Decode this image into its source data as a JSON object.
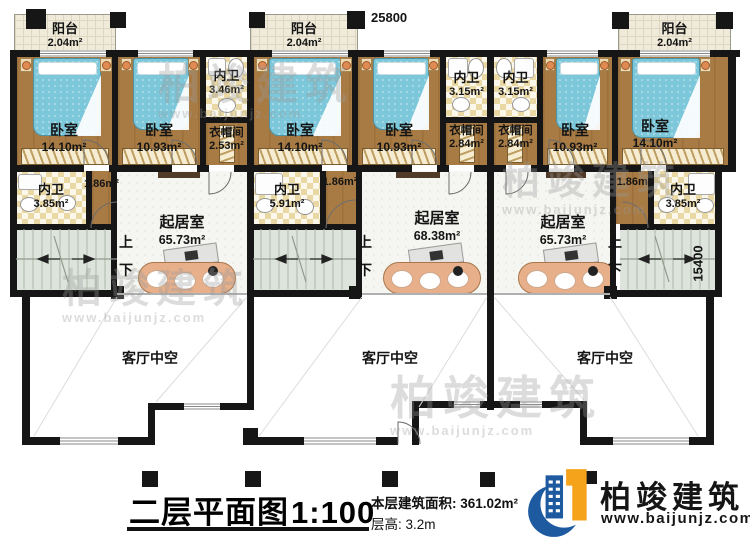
{
  "plan": {
    "dim_top": "25800",
    "dim_right": "15400",
    "up": "上",
    "down": "下",
    "balcony": {
      "name": "阳台",
      "area": "2.04m²"
    },
    "units": [
      {
        "bedroom1": {
          "name": "卧室",
          "area": "14.10m²"
        },
        "bedroom2": {
          "name": "卧室",
          "area": "10.93m²"
        },
        "bath_top": {
          "name": "内卫",
          "area": "3.46m²"
        },
        "closet": {
          "name": "衣帽间",
          "area": "2.53m²"
        },
        "hall_area": "1.86m²",
        "bath_mid": {
          "name": "内卫",
          "area": "3.85m²"
        },
        "living": {
          "name": "起居室",
          "area": "65.73m²"
        },
        "void_label": "客厅中空"
      },
      {
        "bedroom1": {
          "name": "卧室",
          "area": "14.10m²"
        },
        "bedroom2": {
          "name": "卧室",
          "area": "10.93m²"
        },
        "bath_top": {
          "name": "内卫",
          "area": "3.15m²"
        },
        "closet": {
          "name": "衣帽间",
          "area": "2.84m²"
        },
        "hall_area": "1.86m²",
        "bath_mid": {
          "name": "内卫",
          "area": "5.91m²"
        },
        "living": {
          "name": "起居室",
          "area": "68.38m²"
        },
        "void_label": "客厅中空"
      },
      {
        "bedroom1": {
          "name": "卧室",
          "area": "14.10m²"
        },
        "bedroom2": {
          "name": "卧室",
          "area": "10.93m²"
        },
        "bath_top": {
          "name": "内卫",
          "area": "3.15m²"
        },
        "closet": {
          "name": "衣帽间",
          "area": "2.84m²"
        },
        "hall_area": "1.86m²",
        "bath_mid": {
          "name": "内卫",
          "area": "3.85m²"
        },
        "living": {
          "name": "起居室",
          "area": "65.73m²"
        },
        "void_label": "客厅中空"
      }
    ]
  },
  "titleblock": {
    "title": "二层平面图",
    "scale": "1:100",
    "area_label": "本层建筑面积:",
    "area_value": "361.02m²",
    "floor_height_label": "层高:",
    "floor_height_value": "3.2m"
  },
  "logo": {
    "company": "柏竣建筑",
    "website": "www.baijunjz.com",
    "blue": "#1e5aa0",
    "orange": "#f6a31c"
  },
  "watermark": {
    "text": "柏竣建筑",
    "website": "www.baijunjz.com"
  }
}
